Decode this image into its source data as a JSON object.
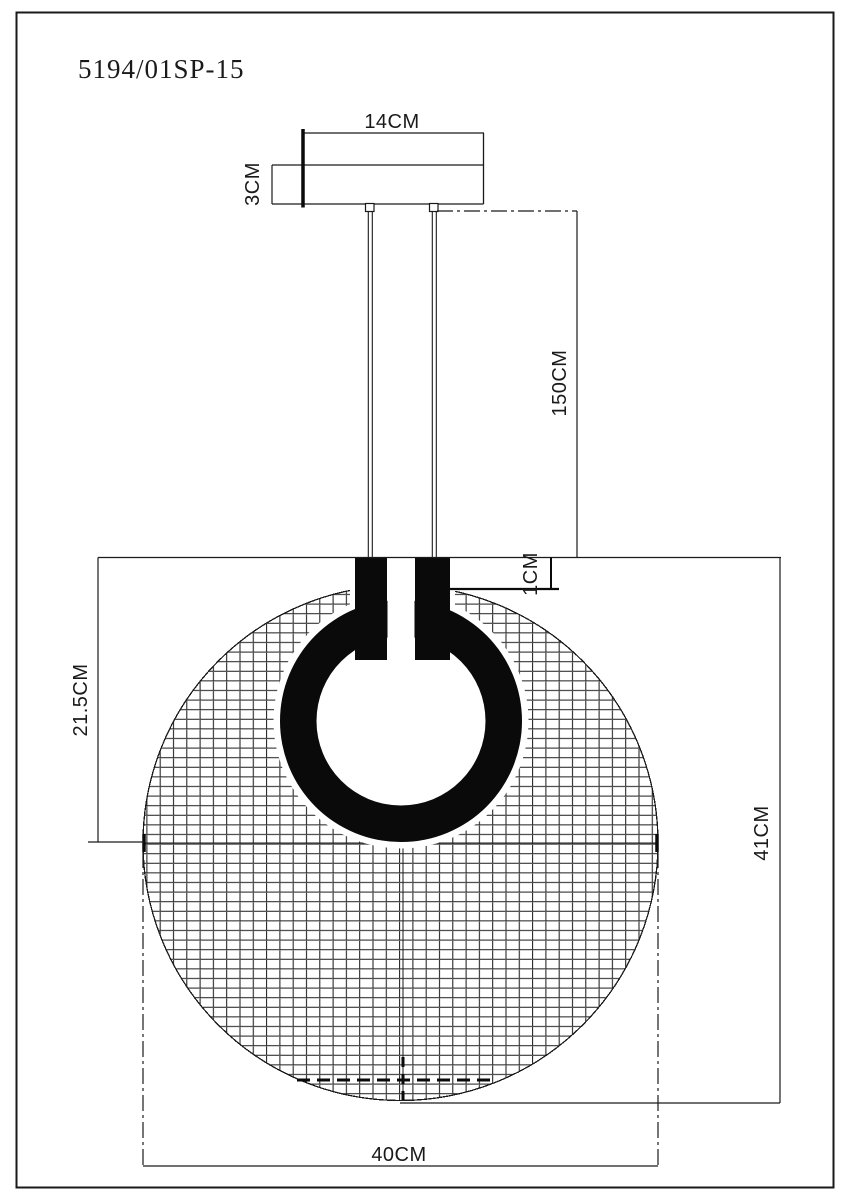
{
  "colors": {
    "background": "#ffffff",
    "line": "#000000",
    "ring_fill": "#0a0a0a"
  },
  "title": "5194/01SP-15",
  "dimensions": {
    "canopy_width": "14CM",
    "canopy_height": "3CM",
    "cable_length": "150CM",
    "ring_top_offset": "1CM",
    "top_to_center": "21.5CM",
    "fixture_height": "41CM",
    "shade_diameter": "40CM"
  }
}
